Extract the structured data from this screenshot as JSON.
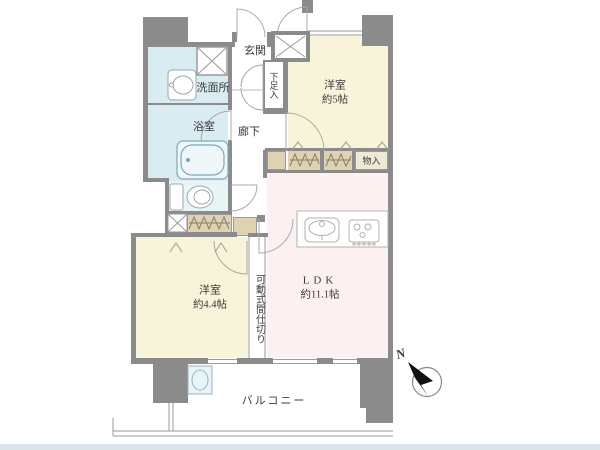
{
  "rooms": {
    "entrance": {
      "label": "玄関"
    },
    "washroom": {
      "label": "洗面所"
    },
    "bathroom": {
      "label": "浴室"
    },
    "hallway": {
      "label": "廊下"
    },
    "shoe_storage": {
      "label": "下足入"
    },
    "western_room_5": {
      "label": "洋室",
      "size": "約5帖"
    },
    "storage": {
      "label": "物入"
    },
    "ldk": {
      "label": "LDK",
      "size": "約11.1帖"
    },
    "movable_partition": {
      "label": "可動式間仕切り"
    },
    "western_room_44": {
      "label": "洋室",
      "size": "約4.4帖"
    },
    "balcony": {
      "label": "バルコニー"
    }
  },
  "compass": {
    "north_label": "N"
  },
  "colors": {
    "wall": "#8b8b8b",
    "room_cream": "#f8f4da",
    "room_pink": "#fcf0f1",
    "water_blue": "#d9ecf2",
    "water_light": "#e9f4f7",
    "closet_tan": "#dfd2b2",
    "closet_light": "#efe8d5",
    "line": "#9a9a9a",
    "text": "#3a3a3a",
    "bottom_strip": "#dbe4e9"
  }
}
